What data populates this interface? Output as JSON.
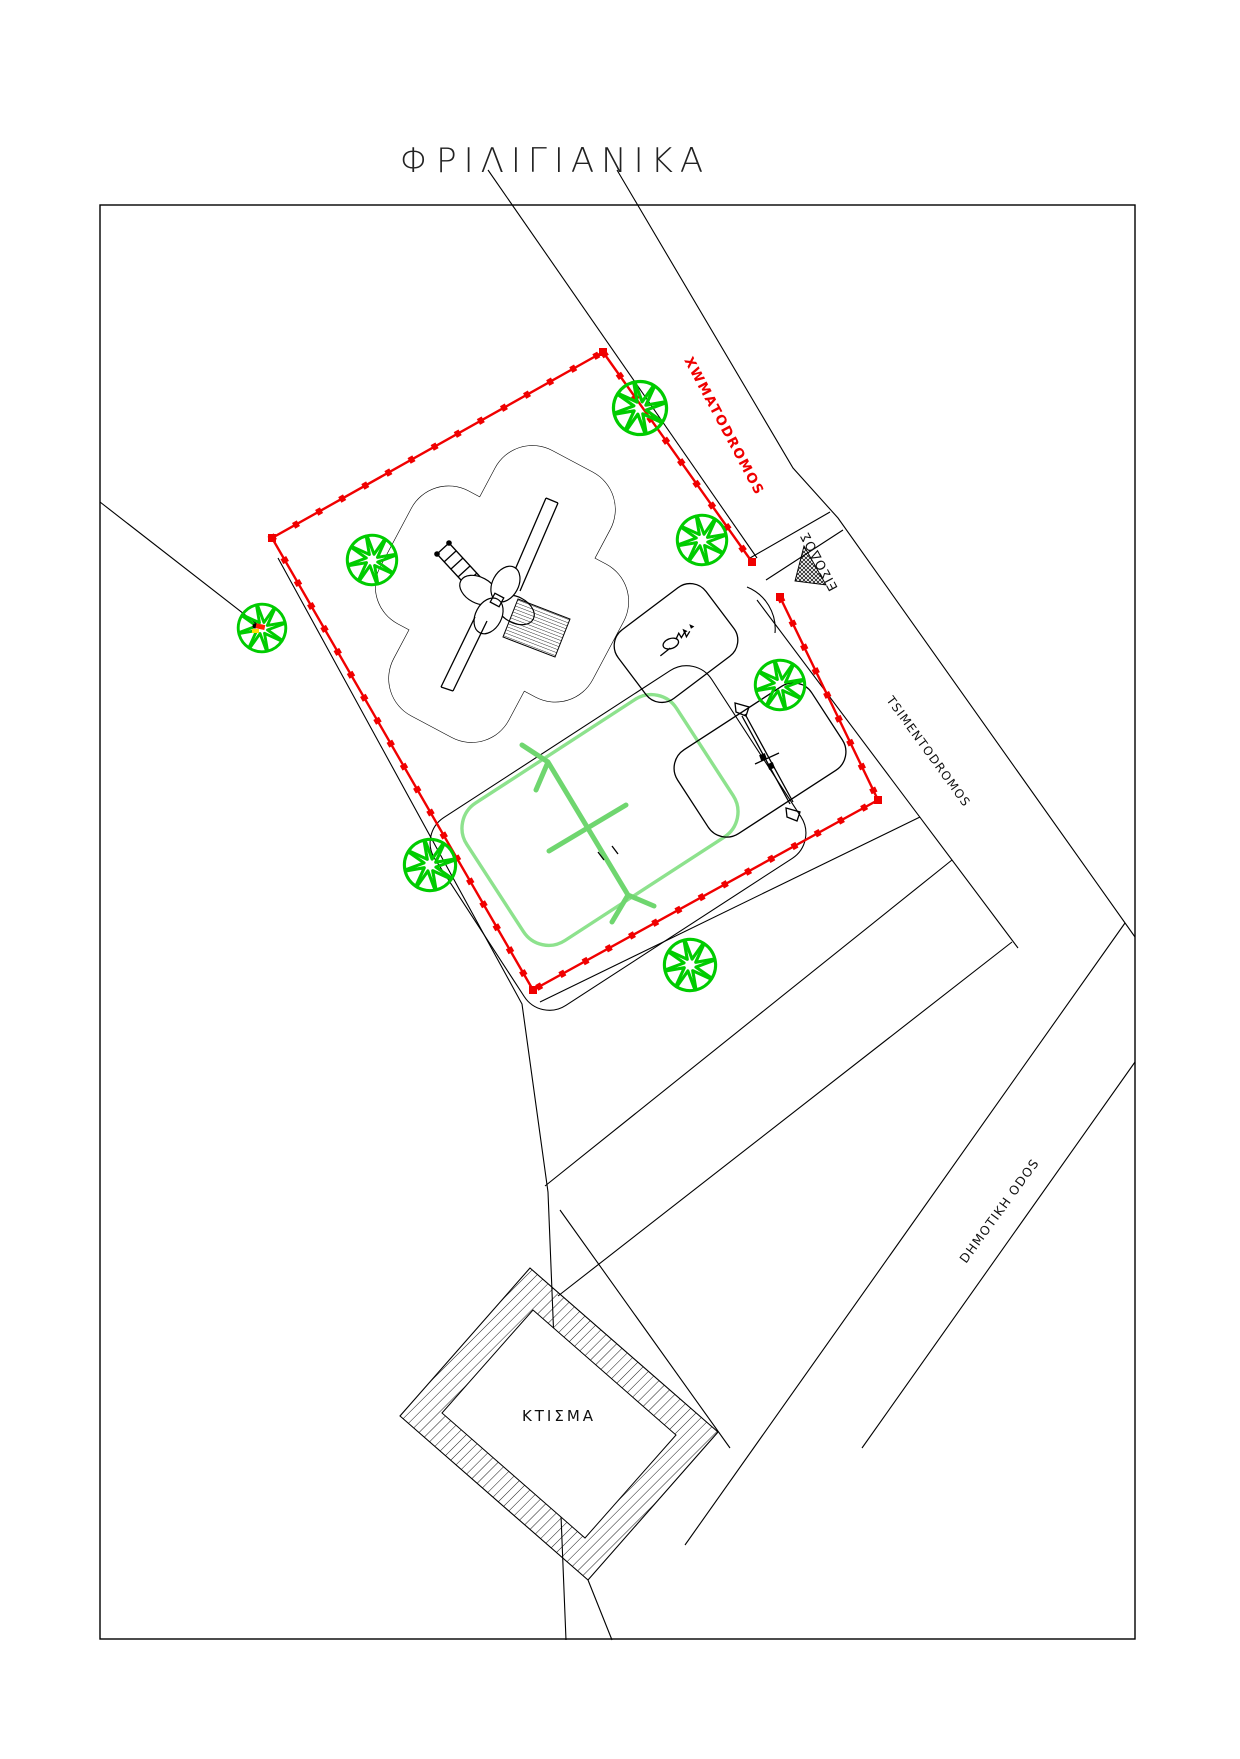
{
  "title": "ΦΡΙΛΙΓΙΑΝΙΚΑ",
  "labels": {
    "dirt_road": {
      "text": "XWMATODROMOS"
    },
    "entrance": {
      "text": "ΕΙΣΟΔΟΣ"
    },
    "cement_road": {
      "text": "TSIMENTODROMOS"
    },
    "municipal_road": {
      "text": "DHMOTIKH ODOS"
    },
    "building": {
      "text": "ΚΤΙΣΜΑ"
    }
  },
  "colors": {
    "boundary": "#f00000",
    "tree": "#00cc00",
    "court": "#8de28d",
    "swing": "#6fd66f",
    "marker_red": "#ff2000",
    "marker_yellow": "#ffdd00"
  },
  "trees": [
    {
      "cx": 640,
      "cy": 408,
      "r": 29
    },
    {
      "cx": 702,
      "cy": 540,
      "r": 27
    },
    {
      "cx": 372,
      "cy": 560,
      "r": 27
    },
    {
      "cx": 262,
      "cy": 628,
      "r": 26
    },
    {
      "cx": 430,
      "cy": 865,
      "r": 28
    },
    {
      "cx": 690,
      "cy": 965,
      "r": 28
    },
    {
      "cx": 780,
      "cy": 685,
      "r": 27
    }
  ],
  "boundary": {
    "edges": [
      [
        [
          603,
          352
        ],
        [
          752,
          562
        ]
      ],
      [
        [
          780,
          597
        ],
        [
          878,
          800
        ],
        [
          533,
          990
        ],
        [
          272,
          538
        ],
        [
          603,
          352
        ]
      ]
    ],
    "corners": [
      [
        603,
        352
      ],
      [
        752,
        562
      ],
      [
        780,
        597
      ],
      [
        878,
        800
      ],
      [
        533,
        990
      ],
      [
        272,
        538
      ]
    ]
  }
}
